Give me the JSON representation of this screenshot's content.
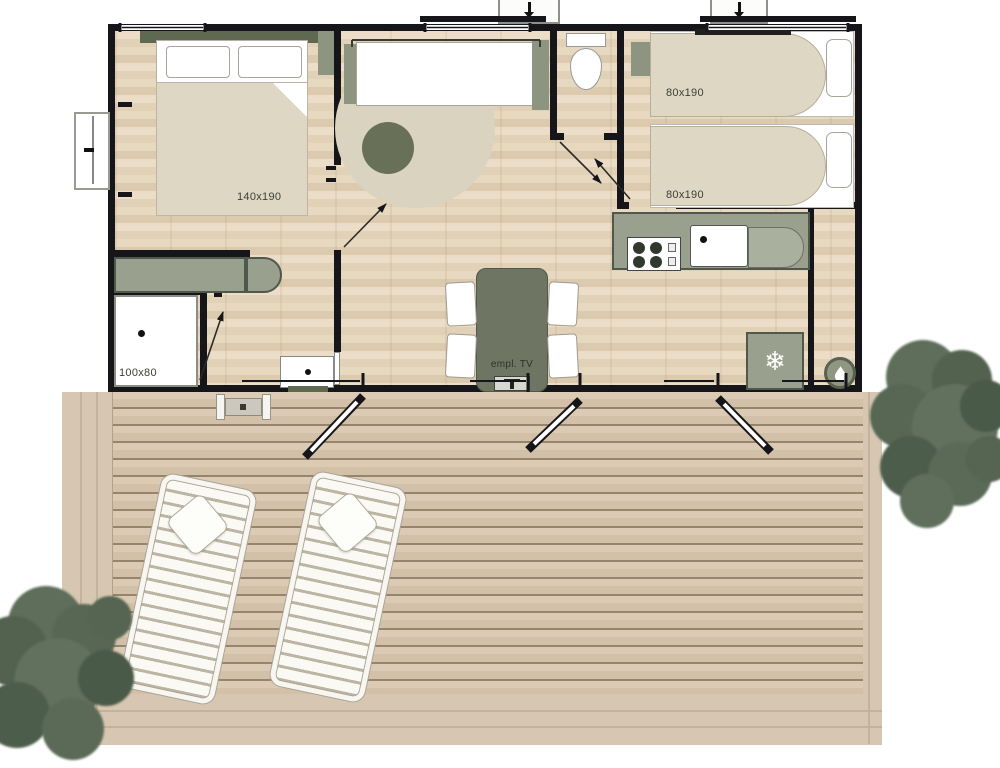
{
  "title": "Mobile home floor plan with wooden deck",
  "rooms": {
    "master_bedroom": {
      "bed_label": "140x190"
    },
    "kids_bedroom": {
      "bed_top_label": "80x190",
      "bed_bottom_label": "80x190"
    },
    "bathroom": {
      "shower_label": "100x80"
    },
    "living_room": {
      "tv_label": "empl. TV"
    }
  },
  "icons": {
    "fridge": {
      "name": "snowflake-icon",
      "glyph": "❄"
    },
    "water_heater": {
      "name": "water-drop-icon"
    }
  },
  "colors": {
    "wall": "#15151a",
    "olive_dark": "#5f6850",
    "olive_mid": "#8d947f",
    "olive_light": "#99a08d",
    "floor_wood": "#e7d8c0",
    "rug_beige": "#d9d3c0",
    "bed_cover": "#ded7c3",
    "deck_wood": "#d7c7b2",
    "tree_green": "#5d6d5a"
  }
}
